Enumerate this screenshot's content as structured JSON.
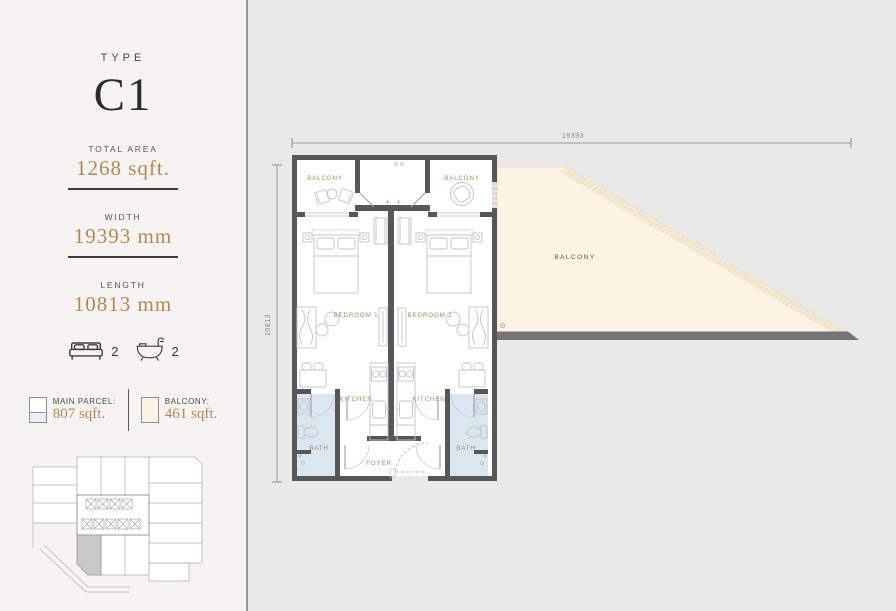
{
  "unit": {
    "type_label": "TYPE",
    "type_name": "C1"
  },
  "specs": {
    "total_area": {
      "label": "TOTAL AREA",
      "value": "1268 sqft."
    },
    "width": {
      "label": "WIDTH",
      "value": "19393 mm"
    },
    "length": {
      "label": "LENGTH",
      "value": "10813 mm"
    }
  },
  "features": {
    "bedrooms": "2",
    "bathrooms": "2"
  },
  "legend": {
    "main_parcel": {
      "label": "MAIN PARCEL:",
      "value": "807 sqft.",
      "color": "#ffffff"
    },
    "balcony": {
      "label": "BALCONY:",
      "value": "461 sqft.",
      "color": "#fdf3e3"
    }
  },
  "floorplan": {
    "dimensions": {
      "width_mm": "19393",
      "length_mm": "10813"
    },
    "labels": {
      "balcony_left": "BALCONY",
      "balcony_right": "BALCONY",
      "balcony_large": "BALCONY",
      "bedroom_1": "BEDROOM 1",
      "bedroom_2": "BEDROOM 2",
      "kitchen_left": "KITCHEN",
      "kitchen_right": "KITCHEN",
      "bath_left": "BATH",
      "bath_right": "BATH",
      "foyer": "FOYER"
    }
  },
  "colors": {
    "accent_gold": "#b5884f",
    "wall": "#57575a",
    "balcony_fill": "#fdf4e6",
    "bath_floor": "#dbe7f0",
    "sidebar_bg": "#f5f4f2",
    "canvas_bg": "#e9e9e8",
    "keyplan_highlight": "#c9c9c9"
  }
}
